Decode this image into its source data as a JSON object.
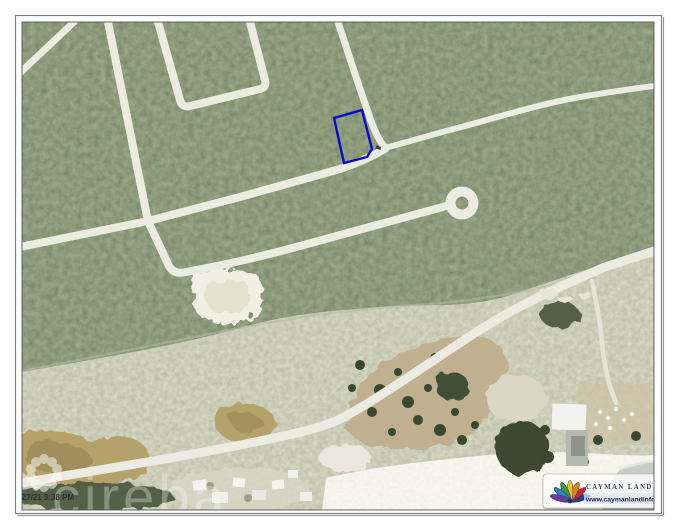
{
  "page": {
    "background": "#ffffff"
  },
  "map": {
    "description": "aerial-satellite-photo-with-parcel-overlay",
    "parcel": {
      "outline_color": "#0a0acf",
      "vertices": [
        [
          334,
          118
        ],
        [
          362,
          110
        ],
        [
          372,
          149
        ],
        [
          367,
          157
        ],
        [
          344,
          163
        ]
      ]
    }
  },
  "watermarks": {
    "timestamp": "1/27/21 3:38 PM",
    "agency_name": "cireba"
  },
  "branding": {
    "name": "CAYMAN LAND INFO",
    "url": "www.caymanlandinfo.ky",
    "name_color": "#3c4c66",
    "url_color": "#14246e"
  }
}
